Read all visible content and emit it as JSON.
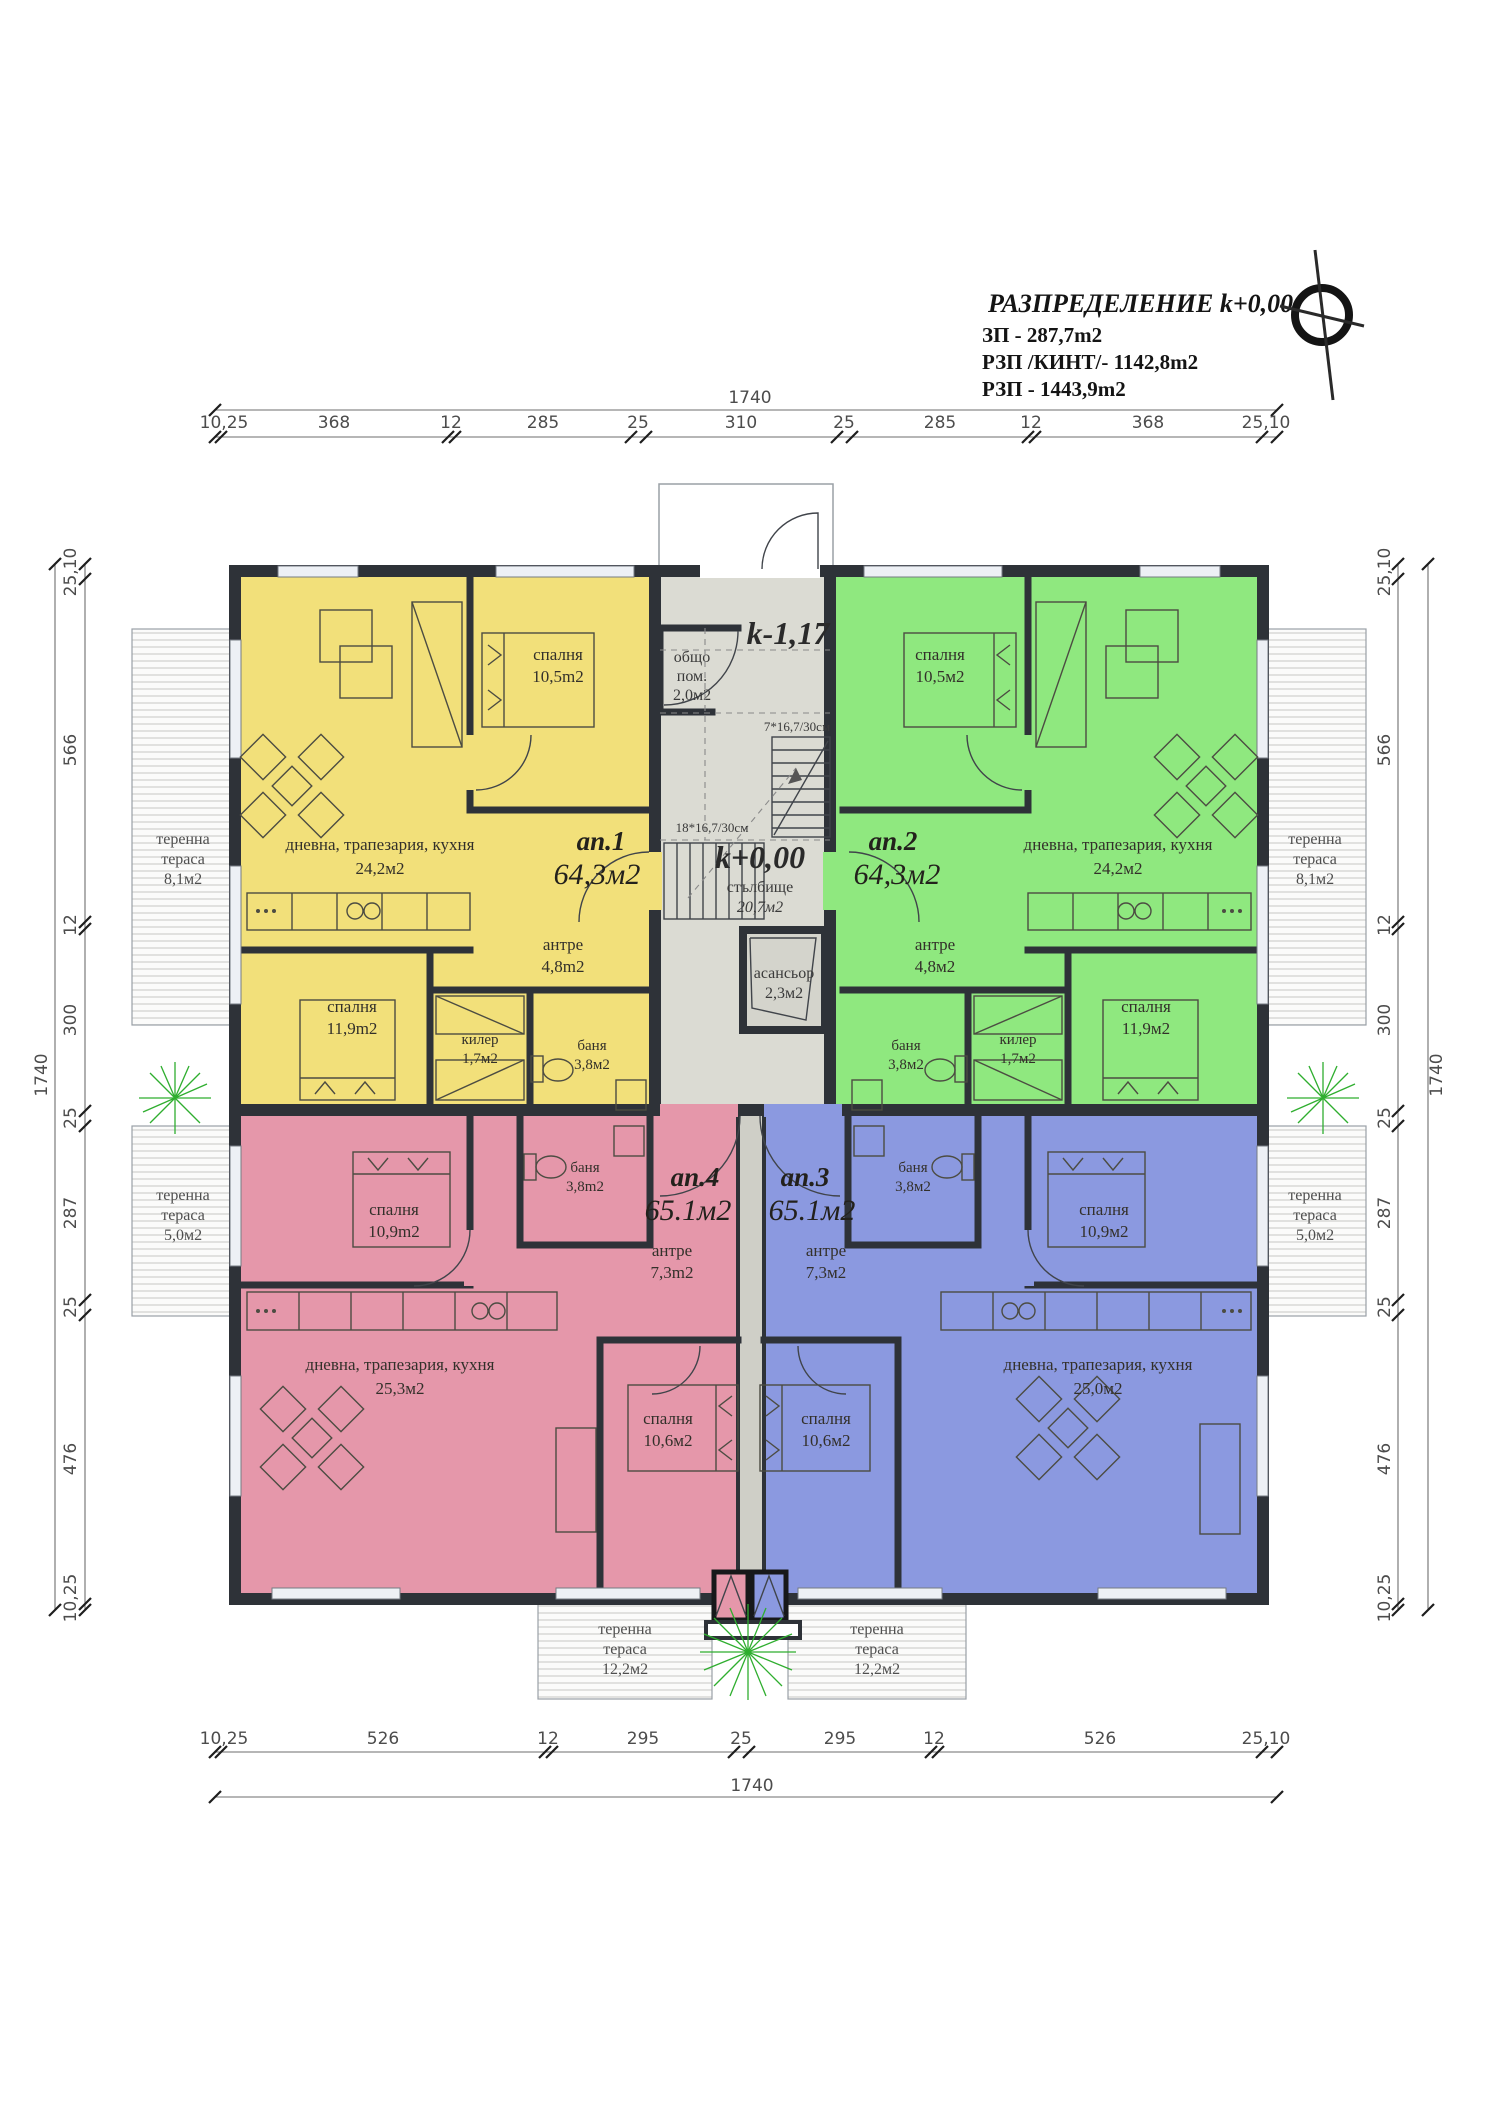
{
  "title_block": {
    "title": "РАЗПРЕДЕЛЕНИЕ k+0,00",
    "zp": "ЗП - 287,7m2",
    "rzp_kint": "РЗП /КИНТ/- 1142,8m2",
    "rzp": "РЗП  - 1443,9m2"
  },
  "dimensions": {
    "top": {
      "total": "1740",
      "segments": [
        "10,25",
        "368",
        "12",
        "285",
        "25",
        "310",
        "25",
        "285",
        "12",
        "368",
        "25,10"
      ]
    },
    "bottom": {
      "total": "1740",
      "segments": [
        "10,25",
        "526",
        "12",
        "295",
        "25",
        "295",
        "12",
        "526",
        "25,10"
      ]
    },
    "left": {
      "total": "1740",
      "segments": [
        "25,10",
        "566",
        "12",
        "300",
        "25",
        "287",
        "25",
        "476",
        "10,25"
      ]
    },
    "right": {
      "total": "1740",
      "segments": [
        "25,10",
        "566",
        "12",
        "300",
        "25",
        "287",
        "25",
        "476",
        "10,25"
      ]
    }
  },
  "core": {
    "upper_level": "k-1,17",
    "common_room_name1": "общо",
    "common_room_name2": "пом.",
    "common_room_area": "2,0м2",
    "stair_upper_run": "7*16,7/30см",
    "stair_lower_run": "18*16,7/30см",
    "level": "k+0,00",
    "stair_name": "стълбище",
    "stair_area": "20,7м2",
    "elevator_name": "асансьор",
    "elevator_area": "2,3м2"
  },
  "apartments": {
    "ap1": {
      "id": "ап.1",
      "area": "64,3м2",
      "color": "#f2e07a",
      "rooms": {
        "bedroom1_name": "спалня",
        "bedroom1_area": "10,5m2",
        "living_name": "дневна, трапезария, кухня",
        "living_area": "24,2м2",
        "hall_name": "антре",
        "hall_area": "4,8m2",
        "bedroom2_name": "спалня",
        "bedroom2_area": "11,9m2",
        "closet_name": "килер",
        "closet_area": "1,7м2",
        "bath_name": "баня",
        "bath_area": "3,8м2"
      }
    },
    "ap2": {
      "id": "ап.2",
      "area": "64,3м2",
      "color": "#8fe87f",
      "rooms": {
        "bedroom1_name": "спалня",
        "bedroom1_area": "10,5м2",
        "living_name": "дневна, трапезария, кухня",
        "living_area": "24,2м2",
        "hall_name": "антре",
        "hall_area": "4,8м2",
        "bedroom2_name": "спалня",
        "bedroom2_area": "11,9м2",
        "closet_name": "килер",
        "closet_area": "1,7м2",
        "bath_name": "баня",
        "bath_area": "3,8м2"
      }
    },
    "ap3": {
      "id": "ап.3",
      "area": "65.1м2",
      "color": "#8b99e0",
      "rooms": {
        "bedroom1_name": "спалня",
        "bedroom1_area": "10,9м2",
        "bath_name": "баня",
        "bath_area": "3,8м2",
        "hall_name": "антре",
        "hall_area": "7,3м2",
        "living_name": "дневна, трапезария, кухня",
        "living_area": "25,0м2",
        "bedroom2_name": "спалня",
        "bedroom2_area": "10,6м2"
      }
    },
    "ap4": {
      "id": "ап.4",
      "area": "65.1м2",
      "color": "#e597aa",
      "rooms": {
        "bedroom1_name": "спалня",
        "bedroom1_area": "10,9m2",
        "bath_name": "баня",
        "bath_area": "3,8m2",
        "hall_name": "антре",
        "hall_area": "7,3m2",
        "living_name": "дневна, трапезария, кухня",
        "living_area": "25,3м2",
        "bedroom2_name": "спалня",
        "bedroom2_area": "10,6м2"
      }
    }
  },
  "terraces": {
    "lt": {
      "n1": "теренна",
      "n2": "тераса",
      "area": "8,1м2"
    },
    "rt": {
      "n1": "теренна",
      "n2": "тераса",
      "area": "8,1м2"
    },
    "lm": {
      "n1": "теренна",
      "n2": "тераса",
      "area": "5,0м2"
    },
    "rm": {
      "n1": "теренна",
      "n2": "тераса",
      "area": "5,0м2"
    },
    "bl": {
      "n1": "теренна",
      "n2": "тераса",
      "area": "12,2м2"
    },
    "br": {
      "n1": "теренна",
      "n2": "тераса",
      "area": "12,2м2"
    }
  }
}
